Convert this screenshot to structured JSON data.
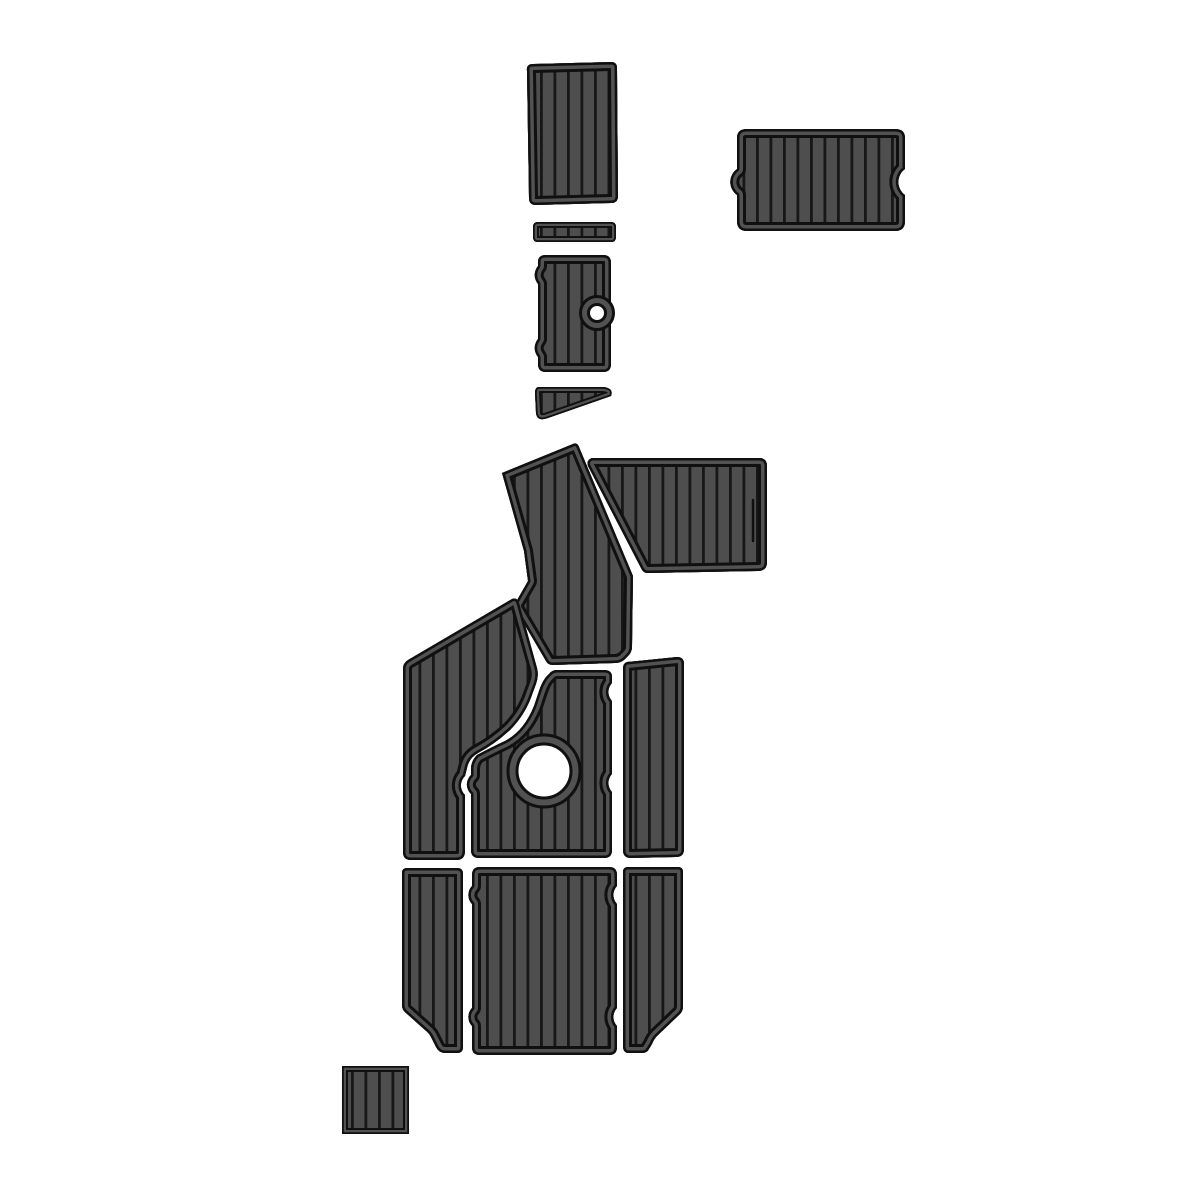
{
  "canvas": {
    "width": 1200,
    "height": 1200,
    "background": "#ffffff"
  },
  "colors": {
    "plank": "#4e4e4e",
    "edge": "#525252",
    "outline": "#101010",
    "stripe": "#171717",
    "hole": "#ffffff",
    "bg": "#ffffff"
  },
  "pattern": {
    "spacing": 13.5,
    "stripe_width": 2.8
  },
  "pieces": {
    "p1": {
      "name": "top-tapered-pad",
      "d": "M533,64 L611,62 Q617,62 617,68 L618,196 Q618,203 611,203 L536,205 Q529,205 529,198 L527,71 Q526,64 533,64 Z"
    },
    "p2": {
      "name": "top-right-notched-pad",
      "d": "M747,129 L895,129 Q905,129 905,138 L905,169 A16,16 0 0 0 905,195 L905,221 Q905,231 895,231 L747,231 Q737,231 737,221 L737,195 A16,16 0 0 1 737,169 L737,138 Q737,129 747,129 Z"
    },
    "p3": {
      "name": "thin-strip-pad",
      "d": "M538,222 L611,222 Q616,222 616,227 L616,237 Q616,242 611,242 L538,242 Q533,242 533,237 L533,227 Q533,222 538,222 Z",
      "small": true
    },
    "p4": {
      "name": "hole-pad-small",
      "d": "M546,255 L603,255 Q611,255 611,263 L611,364 Q611,372 603,372 L546,372 Q538,372 538,364 L538,357 A14,14 0 0 1 538,339 L538,284 A14,14 0 0 1 538,266 L538,262 Q538,255 546,255 Z"
    },
    "p5": {
      "name": "wedge-pad",
      "d": "M539,387 L603,387 Q614,388 611,396 L548,418 Q537,422 536,413 L535,393 Q535,387 539,387 Z",
      "small": true
    },
    "p6": {
      "name": "angled-column-pad",
      "d": "M502,473 L573,444 Q577,442 579,447 L633,576 L632,647 Q632,652 628,656 L624,660 Q620,663 615,663 L553,665 Q548,665 546,661 L516,610 Q514,606 516,602 L528,581 L524,551 Z"
    },
    "p7": {
      "name": "upper-right-wide-pad",
      "d": "M592,458 L759,458 Q767,458 767,466 L767,562 Q767,571 758,571 L648,573 Q643,573 641,568 L588,466 Q586,460 592,458 Z"
    },
    "p8": {
      "name": "left-curved-pad",
      "d": "M512,599 Q517,597 519,603 L537,668 Q539,676 536,684 L533,692 Q526,714 510,730 Q495,744 478,753 Q469,758 467,768 L465,776 A13,13 0 0 0 465,795 L465,851 Q465,860 456,860 L411,860 Q403,860 403,852 L403,669 Q403,663 408,660 Z"
    },
    "p9": {
      "name": "center-hole-pad",
      "d": "M557,670 L604,670 Q612,670 612,677 L612,683 A13,13 0 0 0 612,701 L612,774 A13,13 0 0 0 612,792 L612,850 Q612,858 604,858 L479,858 Q471,858 471,850 L471,794 A13,13 0 0 1 471,775 L471,769 Q471,761 477,755 Q492,747 505,741 Q524,731 534,706 L539,691 Q543,679 549,674 Q552,670 557,670 Z"
    },
    "p10": {
      "name": "mid-right-pad",
      "d": "M627,662 L677,657 Q684,657 684,664 L684,849 Q684,857 676,857 L631,858 Q623,858 623,850 L623,669 Q623,663 627,662 Z"
    },
    "p11": {
      "name": "bottom-left-pad",
      "d": "M407,868 L457,868 Q463,868 463,874 L463,1047 Q463,1053 457,1053 L445,1053 Q439,1053 436,1047 L431,1037 Q429,1033 425,1030 L406,1013 Q402,1010 402,1005 L402,873 Q402,868 407,868 Z"
    },
    "p12": {
      "name": "bottom-center-pad",
      "d": "M480,867 L609,867 Q617,867 617,875 L617,886 A13,13 0 0 0 617,904 L617,1008 A13,13 0 0 0 617,1026 L617,1047 Q617,1055 609,1055 L480,1055 Q472,1055 472,1047 L472,1026 A13,13 0 0 1 472,1008 L472,904 A13,13 0 0 1 472,886 L472,875 Q472,867 480,867 Z"
    },
    "p13": {
      "name": "bottom-right-pad",
      "d": "M628,867 L678,867 Q683,867 683,872 L683,1006 Q683,1011 680,1014 L657,1036 Q654,1039 652,1044 L649,1049 Q647,1053 642,1053 L629,1053 Q623,1053 623,1046 L623,872 Q623,867 628,867 Z"
    },
    "p14": {
      "name": "small-square-pad",
      "d": "M342,1066 L409,1066 L409,1134 L342,1134 Z",
      "small": true
    }
  },
  "holes": {
    "small": {
      "cx": 597,
      "cy": 313,
      "r_outer": 16.5,
      "r_inner": 8.5
    },
    "large": {
      "cx": 544,
      "cy": 771,
      "r_outer": 36,
      "r_inner": 27
    }
  },
  "details": {
    "p7_seam": "M753,500 L753,541"
  }
}
